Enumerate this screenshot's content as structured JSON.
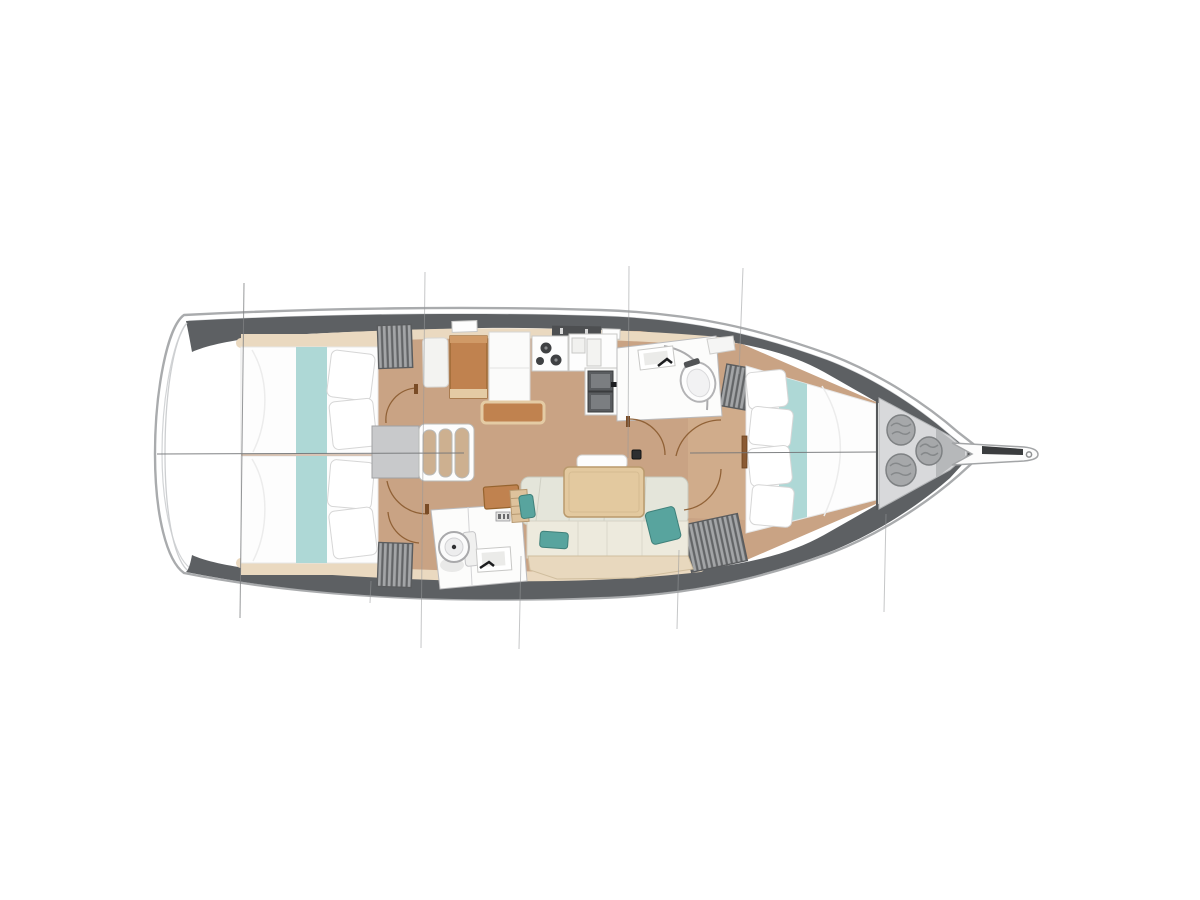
{
  "image": {
    "description": "Top-down interior layout plan of a sailing yacht, bow pointing right, stern left, no text labels",
    "width_px": 1200,
    "height_px": 900
  },
  "colors": {
    "background": "#ffffff",
    "hull_outline": "#a9abad",
    "deck_band_dark": "#5d6063",
    "wood_trim_light": "#ead9c0",
    "floor_wood": "#c9a384",
    "furniture_orange": "#c0824f",
    "bed_runner_teal": "#aad6d4",
    "cushion_teal": "#58a49e",
    "sofa_back": "#e4e5da",
    "sofa_seat": "#edeadd",
    "sofa_front_wood": "#e8d8be",
    "locker_gray": "#a3a5a7",
    "locker_stripe": "#626466",
    "fixture_white": "#fcfcfb",
    "anchor_locker_gray": "#d8d9db",
    "rope_coil_gray": "#a6a8aa",
    "door_swing_arc": "#8a5a2e",
    "rigging_line": "#97999b",
    "table_wood": "#e3c99f"
  },
  "layout": {
    "orientation": {
      "bow": "right",
      "stern": "left"
    },
    "centerline_visible": true,
    "rigging_section_lines": 8,
    "rooms": [
      {
        "name": "aft-cabin-port",
        "features": [
          "double-berth",
          "teal-runner",
          "two-pillows",
          "hanging-locker"
        ]
      },
      {
        "name": "aft-cabin-starboard",
        "features": [
          "double-berth",
          "teal-runner",
          "two-pillows",
          "hanging-locker"
        ]
      },
      {
        "name": "companionway",
        "features": [
          "landing-pad",
          "three-steps"
        ]
      },
      {
        "name": "nav-station",
        "features": [
          "seat",
          "chart-table",
          "cabinet",
          "bench"
        ]
      },
      {
        "name": "galley",
        "features": [
          "three-burner-stove",
          "counter-with-icebox-lids",
          "double-sink",
          "faucet"
        ]
      },
      {
        "name": "aft-head",
        "features": [
          "toilet",
          "sink",
          "faucet",
          "panel-icon"
        ]
      },
      {
        "name": "salon",
        "features": [
          "l-shaped-sofa",
          "three-teal-cushions",
          "dining-table",
          "headrest",
          "orange-shelf",
          "ladder-shelf"
        ]
      },
      {
        "name": "forward-head",
        "features": [
          "sink",
          "faucet",
          "toilet",
          "curved-shower-screen",
          "corner-shelf"
        ]
      },
      {
        "name": "forward-cabin",
        "features": [
          "v-berth",
          "teal-runner",
          "four-pillows",
          "two-hanging-lockers",
          "entry-door"
        ]
      },
      {
        "name": "anchor-locker",
        "features": [
          "bulkhead",
          "three-rope-coils"
        ]
      },
      {
        "name": "bowsprit",
        "features": [
          "anchor-roller",
          "tip-ring"
        ]
      }
    ],
    "fixtures": {
      "mast_post": true,
      "deck_hatches": 2,
      "companionway_hatch_garage": 1,
      "door_swing_arcs": 6
    }
  }
}
